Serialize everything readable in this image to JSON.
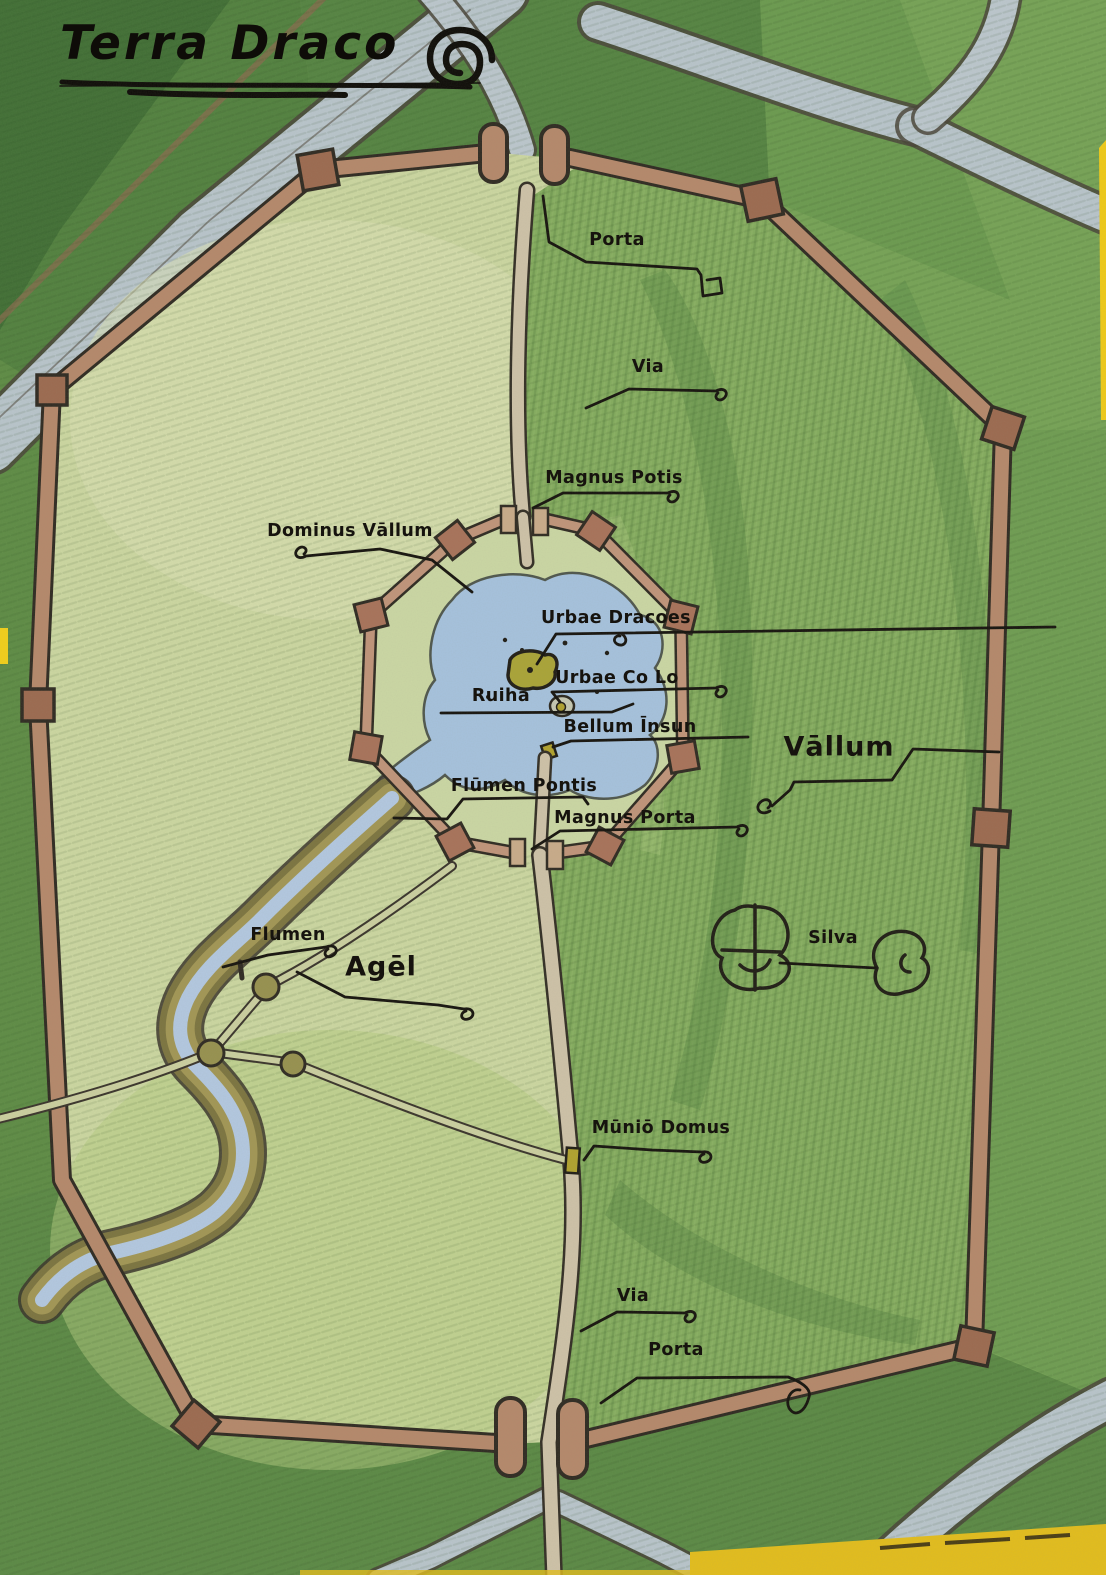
{
  "title": {
    "text": "Terra Draco",
    "glyph": "spiral-icon"
  },
  "labels": {
    "porta_north": "Porta",
    "via_north": "Via",
    "magnus_potis": "Magnus Potis",
    "dominus_vallum": "Dominus Vāllum",
    "urbae_dracoes": "Urbae Dracoes",
    "urbae_co_lo": "Urbae Co Lo",
    "ruiha": "Ruiha",
    "bellum_insun": "Bellum Īnsun",
    "flumen_pontis": "Flūmen Pontis",
    "magnus_porta": "Magnus Porta",
    "vallum": "Vāllum",
    "flumen": "Flumen",
    "agel": "Agēl",
    "silva": "Silva",
    "munio_domus": "Mūniō Domus",
    "via_south": "Via",
    "porta_south": "Porta"
  },
  "palette": {
    "ink": "#1f1b14",
    "field_light": "#ccd7a1",
    "grass_mid": "#76a356",
    "grass_dark": "#4c7a3c",
    "forest_region": "#84ac5e",
    "wall_fill": "#b5886b",
    "tower_fill": "#9c6a50",
    "inner_wall_fill": "#c0947a",
    "road_fill": "#cec2a8",
    "grey_path": "#b9c5cc",
    "pond_blue": "#a6c2de",
    "river_bank": "#7c7440",
    "island_yellow": "#aaa437",
    "scan_edge_yellow": "#e3bd1c"
  }
}
